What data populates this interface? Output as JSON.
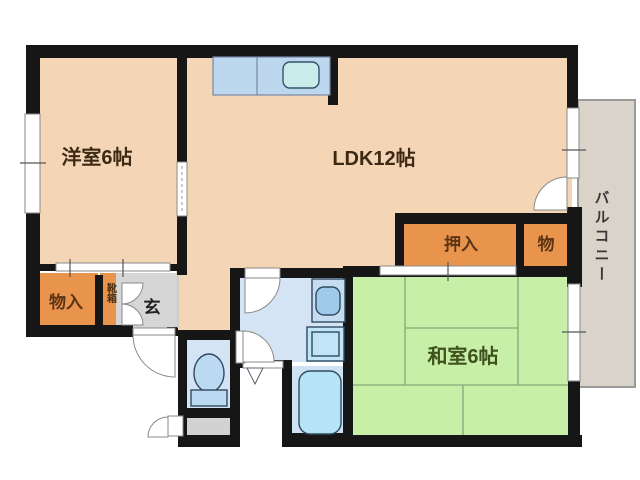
{
  "plan": {
    "type": "japanese-apartment-floor-plan",
    "rooms": {
      "western_room": {
        "label": "洋室6帖",
        "color": "#F4D6B7"
      },
      "ldk": {
        "label": "LDK12帖",
        "color": "#F4D6B7"
      },
      "japanese_room": {
        "label": "和室6帖",
        "color": "#C7EFA7",
        "tatami_mats": 6
      },
      "oshiire": {
        "label": "押入",
        "color": "#E8944C"
      },
      "storage_small": {
        "label": "物",
        "color": "#E8944C"
      },
      "storage": {
        "label": "物入",
        "color": "#E8944C"
      },
      "shoe_box": {
        "label": "靴箱",
        "color": "#E8944C"
      },
      "entrance": {
        "label": "玄",
        "color": "#D6D6D6"
      },
      "balcony": {
        "label": "バルコニー",
        "color": "#D9D3CA"
      }
    },
    "fixtures": [
      "kitchen-counter",
      "kitchen-sink",
      "bathroom-vanity-sink",
      "washing-machine-pan",
      "toilet",
      "bathtub"
    ],
    "colors": {
      "walls": "#161616",
      "room_peach": "#F4D6B7",
      "room_green": "#C7EFA7",
      "closet_orange": "#E8944C",
      "water_area_blue": "#D5E4F5",
      "fixture_blue": "#B7E3F6",
      "entrance_gray": "#D6D6D6",
      "balcony_beige": "#D9D3CA",
      "label_brown": "#4A2F15",
      "label_green": "#3F511C"
    }
  }
}
